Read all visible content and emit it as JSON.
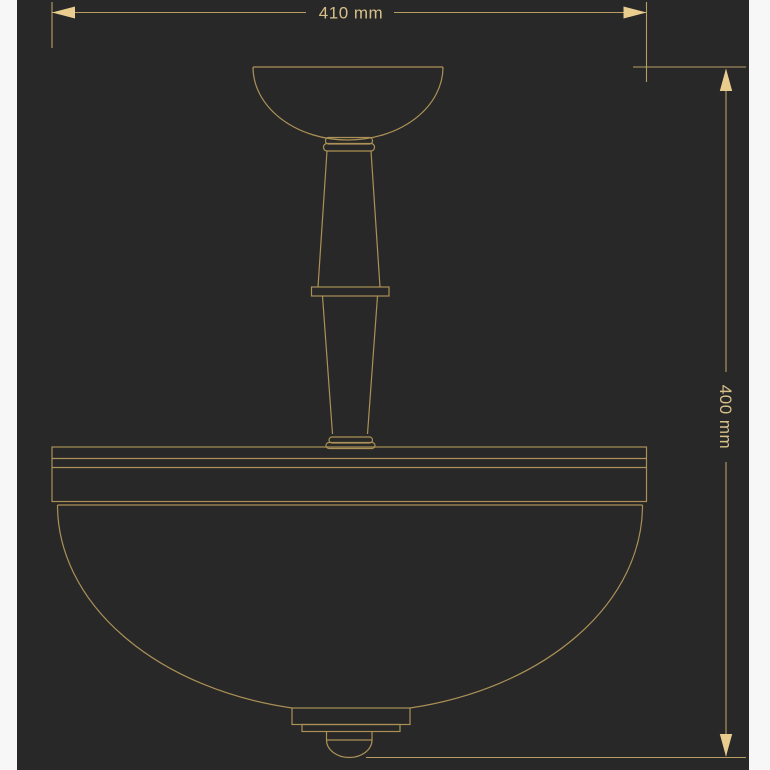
{
  "page": {
    "background_color": "#f7f7f7",
    "canvas_color": "#282828"
  },
  "diagram": {
    "type": "technical-drawing",
    "subject": "semi-flush ceiling lamp, front elevation with overall dimensions",
    "line_color": "#ab9156",
    "arrow_color": "#e9cd8f",
    "label_color": "#d8c08a",
    "dimensions": {
      "width": {
        "label": "410 mm",
        "value": 410,
        "unit": "mm"
      },
      "height": {
        "label": "400 mm",
        "value": 400,
        "unit": "mm"
      }
    }
  }
}
